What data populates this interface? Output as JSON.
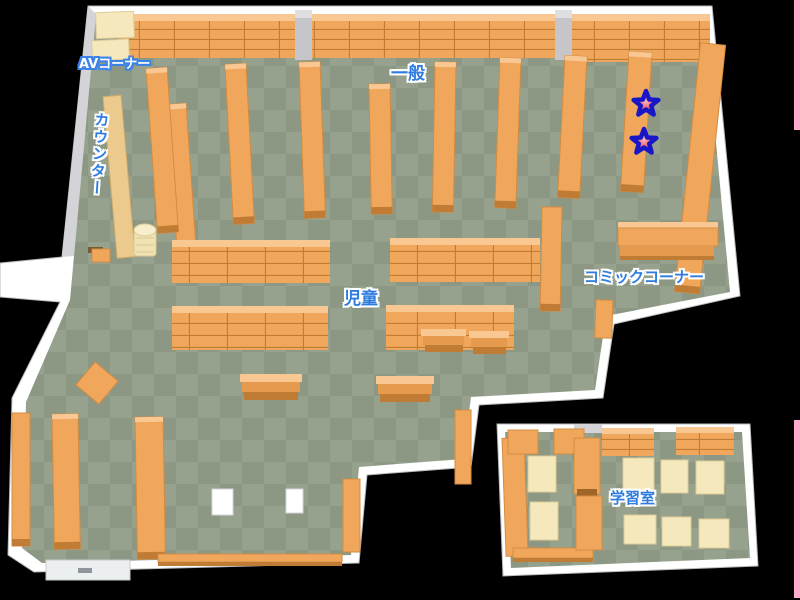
{
  "map": {
    "name": "library-floor-map",
    "areas": {
      "av_corner": {
        "label": "AVコーナー"
      },
      "general": {
        "label": "一般"
      },
      "counter": {
        "label": "カウンター"
      },
      "children": {
        "label": "児童"
      },
      "comic_corner": {
        "label": "コミックコーナー"
      },
      "study_room": {
        "label": "学習室"
      }
    },
    "markers": [
      {
        "type": "star",
        "area": "general"
      },
      {
        "type": "star",
        "area": "general"
      }
    ],
    "colors": {
      "background": "#000000",
      "wall": "#ffffff",
      "wall_shade": "#d4d4d8",
      "floor_dark": "#8c9883",
      "floor_light": "#97a28e",
      "shelf": "#f0a75c",
      "shelf_top": "#f9c792",
      "shelf_side": "#d28c42",
      "shelf_line": "#c07c34",
      "desk": "#f5e8bd",
      "counter": "#ecca8e",
      "pillar": "#c6c6ca",
      "label_blue": "#2e7ce0",
      "label_white": "#ffffff",
      "star_fill": "#ee4b63",
      "star_outline": "#1717c8",
      "edge_strip_pink": "#ffaacf"
    }
  }
}
